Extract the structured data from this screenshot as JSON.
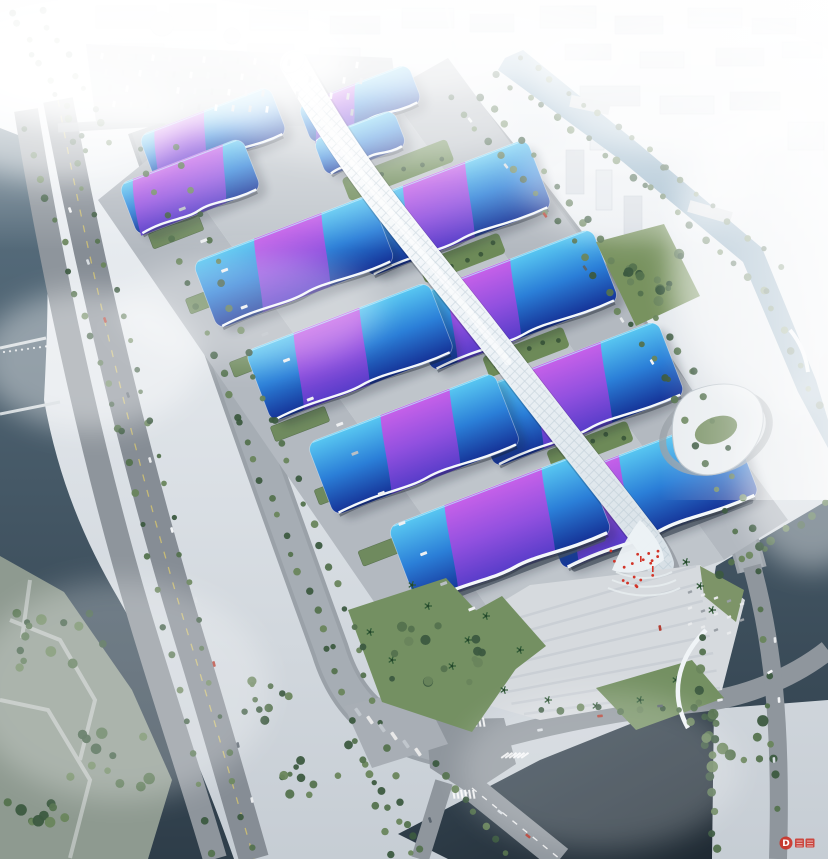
{
  "meta": {
    "type": "architectural-aerial-rendering",
    "subject": "large exhibition and convention center complex, bird's-eye view in hazy daylight"
  },
  "watermark": {
    "symbol": "D"
  },
  "colors": {
    "haze": "#f4f7fa",
    "ground": "#c6cdd4",
    "city": "#dde3e9",
    "roof_cyan": "#59c8f2",
    "roof_mid": "#2b7fd8",
    "roof_deep": "#142f94",
    "ribbon_magenta": "#d058e8",
    "ribbon_purple": "#9a4ce0",
    "ribbon_violet": "#5a3ccc",
    "spine_white": "#ffffff",
    "spine_shade": "#d7e0e6",
    "water": "#5b7282",
    "water_deep": "#2e3d49",
    "canal": "#8fb2ca",
    "pond": "#1f2a33",
    "road": "#9aa1a8",
    "apron": "#b3b9c0",
    "podium": "#bfc5cb",
    "plaza": "#d6dade",
    "tree": "#54724e",
    "lawn": "#6d8a58",
    "accent_red": "#cc3126"
  },
  "scene": {
    "features": [
      "hazy-city-skyline-north",
      "north-parking-lot-with-trucks",
      "northeast-canal-with-bridges",
      "west-river-with-weirs",
      "riverside-park-southwest",
      "elevated-riverside-roads",
      "tree-lined-boulevards",
      "twin-columns-of-exhibition-halls",
      "blue-gradient-roofs-with-purple-ribbon-graphics",
      "white-serpentine-central-spine-corridor",
      "green-garden-strips-between-halls",
      "landmark-south-halls-with-wavy-white-fascia",
      "south-entrance-plaza-with-palm-trees",
      "red-ceremony-cluster-at-entrance",
      "white-swoosh-building-east",
      "southeast-water-and-road-intersection",
      "curved-pedestrian-bridge",
      "red-watermark-logo"
    ],
    "hall_pairs": 6
  }
}
